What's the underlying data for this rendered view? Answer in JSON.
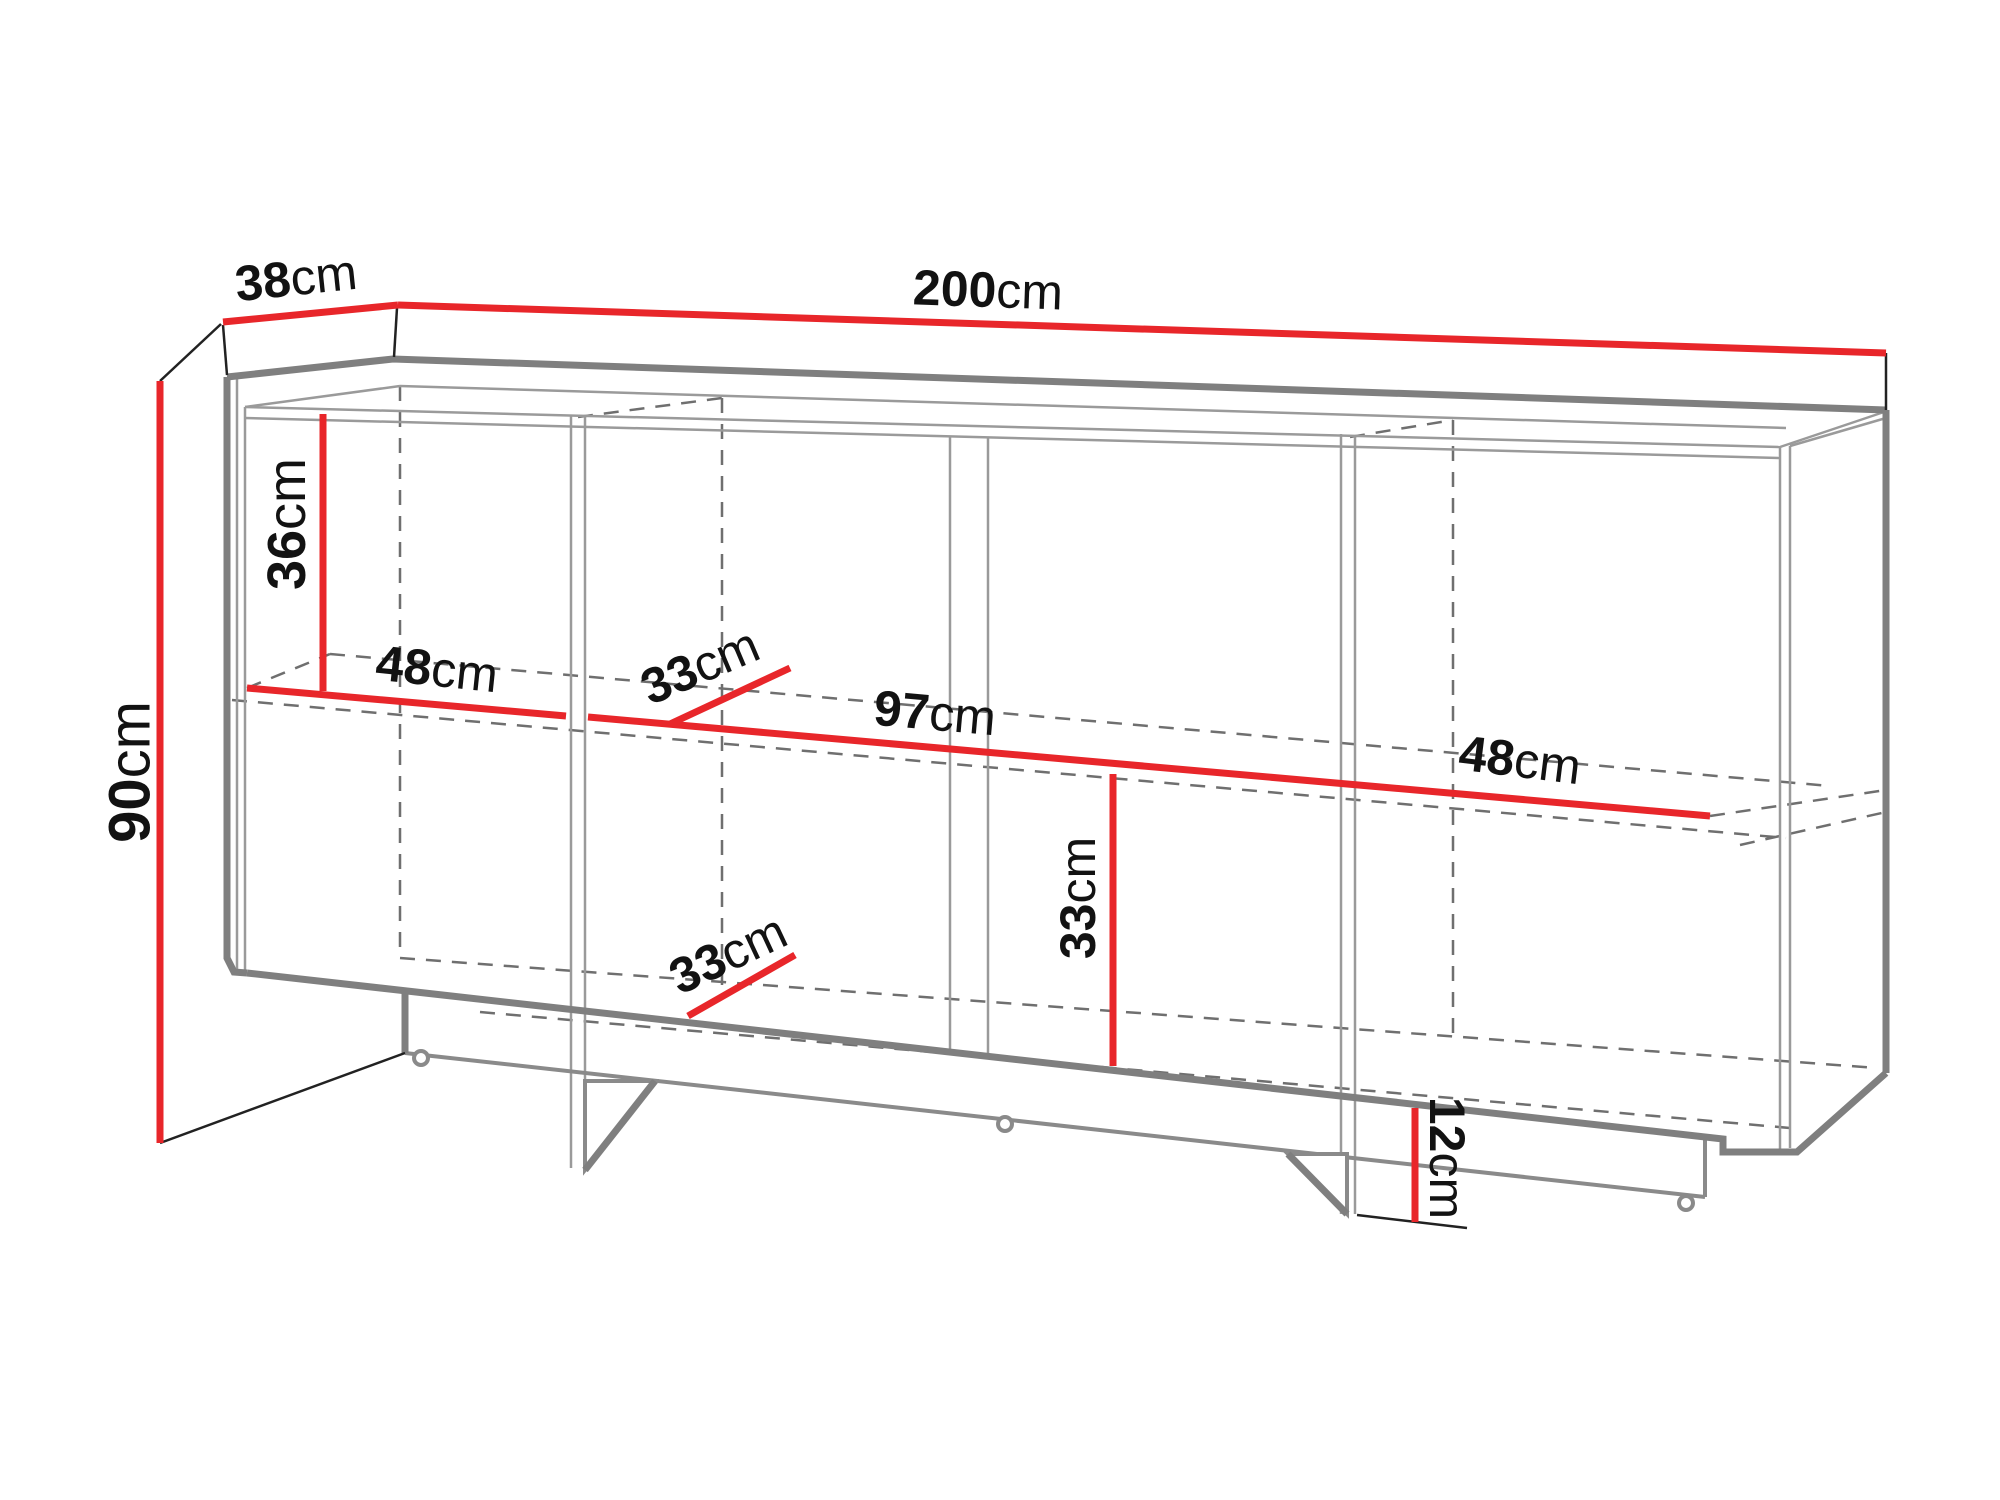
{
  "diagram": {
    "name": "sideboard-cabinet-dimension-drawing",
    "accent_color": "#e8262a",
    "outline_color": "#7f7f7f",
    "dimensions": {
      "depth": {
        "value": "38",
        "unit": "cm"
      },
      "width": {
        "value": "200",
        "unit": "cm"
      },
      "height": {
        "value": "90",
        "unit": "cm"
      },
      "upper_section_height": {
        "value": "36",
        "unit": "cm"
      },
      "left_section_width": {
        "value": "48",
        "unit": "cm"
      },
      "upper_shelf_depth": {
        "value": "33",
        "unit": "cm"
      },
      "middle_section_width": {
        "value": "97",
        "unit": "cm"
      },
      "right_section_width": {
        "value": "48",
        "unit": "cm"
      },
      "lower_shelf_depth": {
        "value": "33",
        "unit": "cm"
      },
      "lower_section_height": {
        "value": "33",
        "unit": "cm"
      },
      "plinth_height": {
        "value": "12",
        "unit": "cm"
      }
    }
  }
}
